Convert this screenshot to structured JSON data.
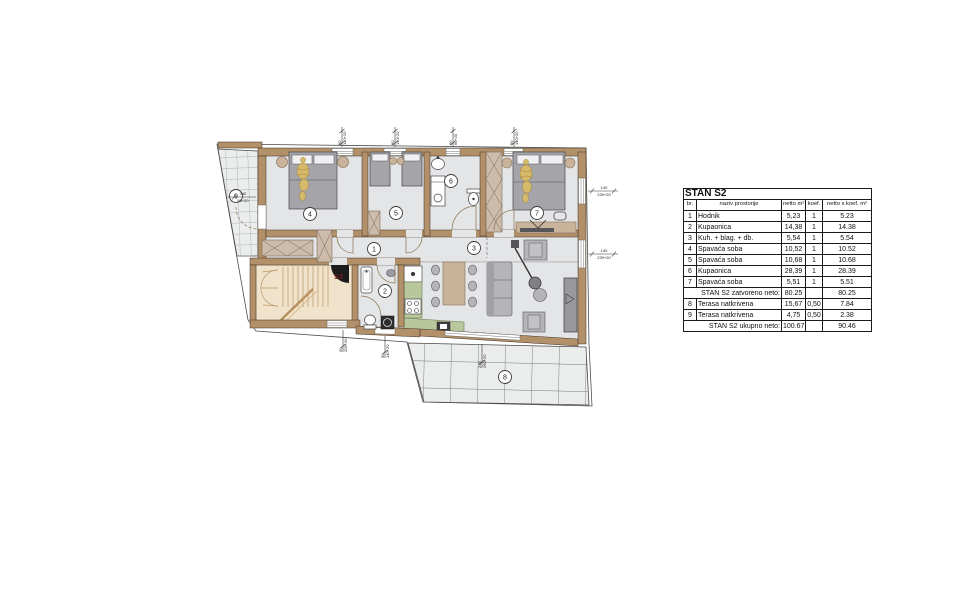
{
  "plan": {
    "apartment_label": "S2",
    "markers": [
      "1",
      "2",
      "3",
      "4",
      "5",
      "6",
      "7",
      "8",
      "9"
    ],
    "dims": {
      "top": [
        {
          "a": "90",
          "b": "140+20"
        },
        {
          "a": "90",
          "b": "140+20"
        },
        {
          "a": "60",
          "b": "60+20"
        },
        {
          "a": "90",
          "b": "140+20"
        }
      ],
      "right": [
        {
          "a": "140",
          "b": "239+20"
        },
        {
          "a": "140",
          "b": "239+20"
        }
      ],
      "bottom": [
        {
          "a": "90",
          "b": "205+20"
        },
        {
          "a": "90",
          "b": "140+20"
        },
        {
          "a": "240",
          "b": "260+20"
        }
      ],
      "left": [
        {
          "a": "240",
          "b": "80+20"
        }
      ]
    },
    "colors": {
      "wall": "#b29069",
      "stair": "#f0e2cb",
      "kitchen": "#b8c89c",
      "terrace_grid": "#73787c",
      "gold": "#d6ba6c"
    }
  },
  "table": {
    "title": "STAN S2",
    "headers": {
      "br": "br.",
      "name": "naziv prostorije",
      "netto": "netto m²",
      "koef": "koef.",
      "total": "netto x koef. m²"
    },
    "rows": [
      {
        "br": "1",
        "name": "Hodnik",
        "netto": "5,23",
        "koef": "1",
        "total": "5.23"
      },
      {
        "br": "2",
        "name": "Kupaonica",
        "netto": "14,38",
        "koef": "1",
        "total": "14.38"
      },
      {
        "br": "3",
        "name": "Kuh. + blag. + db.",
        "netto": "5,54",
        "koef": "1",
        "total": "5.54"
      },
      {
        "br": "4",
        "name": "Spavaća soba",
        "netto": "10,52",
        "koef": "1",
        "total": "10.52"
      },
      {
        "br": "5",
        "name": "Spavaća soba",
        "netto": "10,68",
        "koef": "1",
        "total": "10.68"
      },
      {
        "br": "6",
        "name": "Kupaonica",
        "netto": "28,39",
        "koef": "1",
        "total": "28.39"
      },
      {
        "br": "7",
        "name": "Spavaća soba",
        "netto": "5,51",
        "koef": "1",
        "total": "5.51"
      },
      {
        "br": "8",
        "name": "Terasa natkrivena",
        "netto": "15,67",
        "koef": "0,50",
        "total": "7.84"
      },
      {
        "br": "9",
        "name": "Terasa natkrivena",
        "netto": "4,75",
        "koef": "0,50",
        "total": "2.38"
      }
    ],
    "subtotal": {
      "label": "STAN S2 zatvoreno neto:",
      "netto": "80.25",
      "total": "80.25"
    },
    "grand": {
      "label": "STAN S2 ukupno neto:",
      "netto": "100.67",
      "total": "90.46"
    }
  }
}
